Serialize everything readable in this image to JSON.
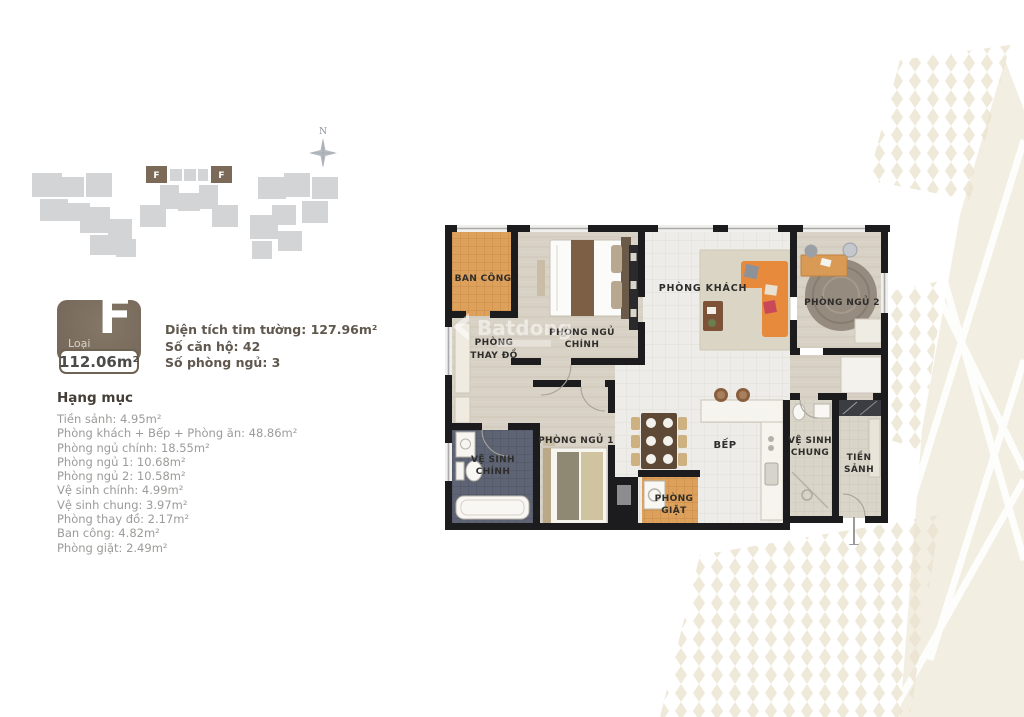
{
  "palette": {
    "badge_brown": "#7b6e5f",
    "marker_brown": "#7a6a57",
    "building_gray": "#d3d4d6",
    "compass_gray": "#b5bac0",
    "heading_text": "#453e37",
    "summary_text": "#60584e",
    "list_text": "#9b9b99",
    "wall_black": "#1c1c1e",
    "wood_floor": "#d8d1c5",
    "tile_white": "#edece8",
    "tile_orange": "#dda15c",
    "bath_dark": "#5e6473",
    "sofa_orange": "#e78a3c",
    "bg_beige": "#f3eee2"
  },
  "site_plan": {
    "compass": "N",
    "marker_1": "F",
    "marker_2": "F"
  },
  "badge": {
    "type_label": "Loại",
    "type_letter": "F",
    "area": "112.06m²"
  },
  "summary": {
    "lines": [
      "Diện tích tim tường: 127.96m²",
      "Số căn hộ: 42",
      "Số phòng ngủ: 3"
    ]
  },
  "categories": {
    "title": "Hạng mục",
    "items": [
      "Tiền sảnh: 4.95m²",
      "Phòng khách + Bếp + Phòng ăn: 48.86m²",
      "Phòng ngủ chính: 18.55m²",
      "Phòng ngủ 1: 10.68m²",
      "Phòng ngủ 2: 10.58m²",
      "Vệ sinh chính: 4.99m²",
      "Vệ sinh chung: 3.97m²",
      "Phòng thay đồ: 2.17m²",
      "Ban công: 4.82m²",
      "Phòng giặt: 2.49m²"
    ]
  },
  "plan": {
    "watermark": "Batdong",
    "rooms": {
      "ban_cong": "BAN CÔNG",
      "phong_ngu_chinh_1": "PHÒNG NGỦ",
      "phong_ngu_chinh_2": "CHÍNH",
      "phong_khach": "PHÒNG KHÁCH",
      "phong_ngu_2": "PHÒNG NGỦ 2",
      "phong_thay_do_1": "PHÒNG",
      "phong_thay_do_2": "THAY ĐỒ",
      "ve_sinh_chinh_1": "VỆ SINH",
      "ve_sinh_chinh_2": "CHÍNH",
      "phong_ngu_1": "PHÒNG NGỦ 1",
      "bep": "BẾP",
      "ve_sinh_chung_1": "VỆ SINH",
      "ve_sinh_chung_2": "CHUNG",
      "tien_sanh_1": "TIỀN",
      "tien_sanh_2": "SẢNH",
      "phong_giat_1": "PHÒNG",
      "phong_giat_2": "GIẶT"
    }
  }
}
